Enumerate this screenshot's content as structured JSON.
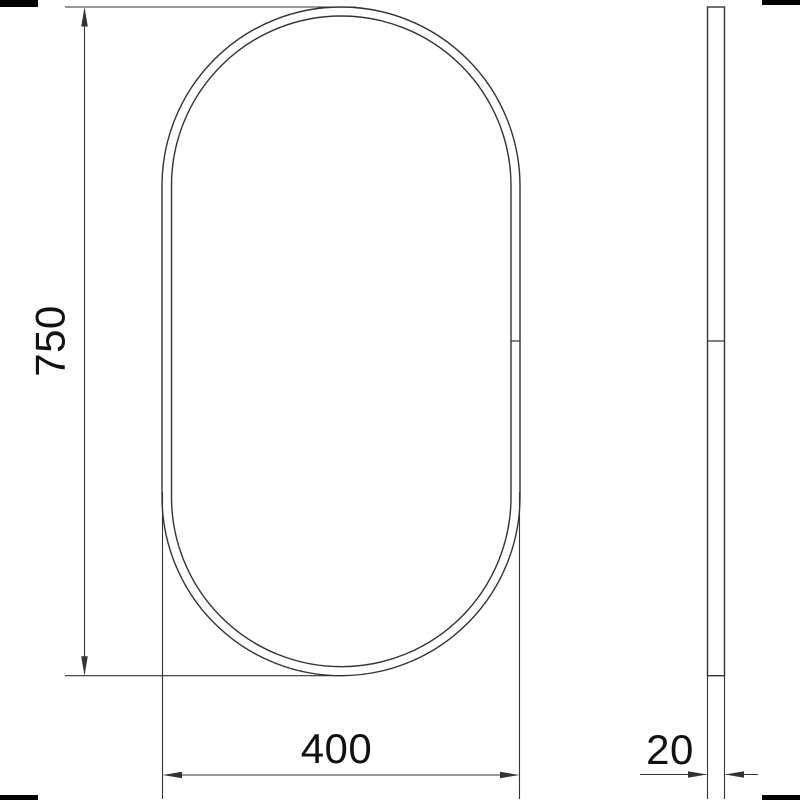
{
  "colors": {
    "line": "#333333",
    "text": "#111111",
    "mark": "#000000",
    "background": "#ffffff"
  },
  "dimensions": {
    "height_label": "750",
    "width_label": "400",
    "thickness_label": "20"
  }
}
